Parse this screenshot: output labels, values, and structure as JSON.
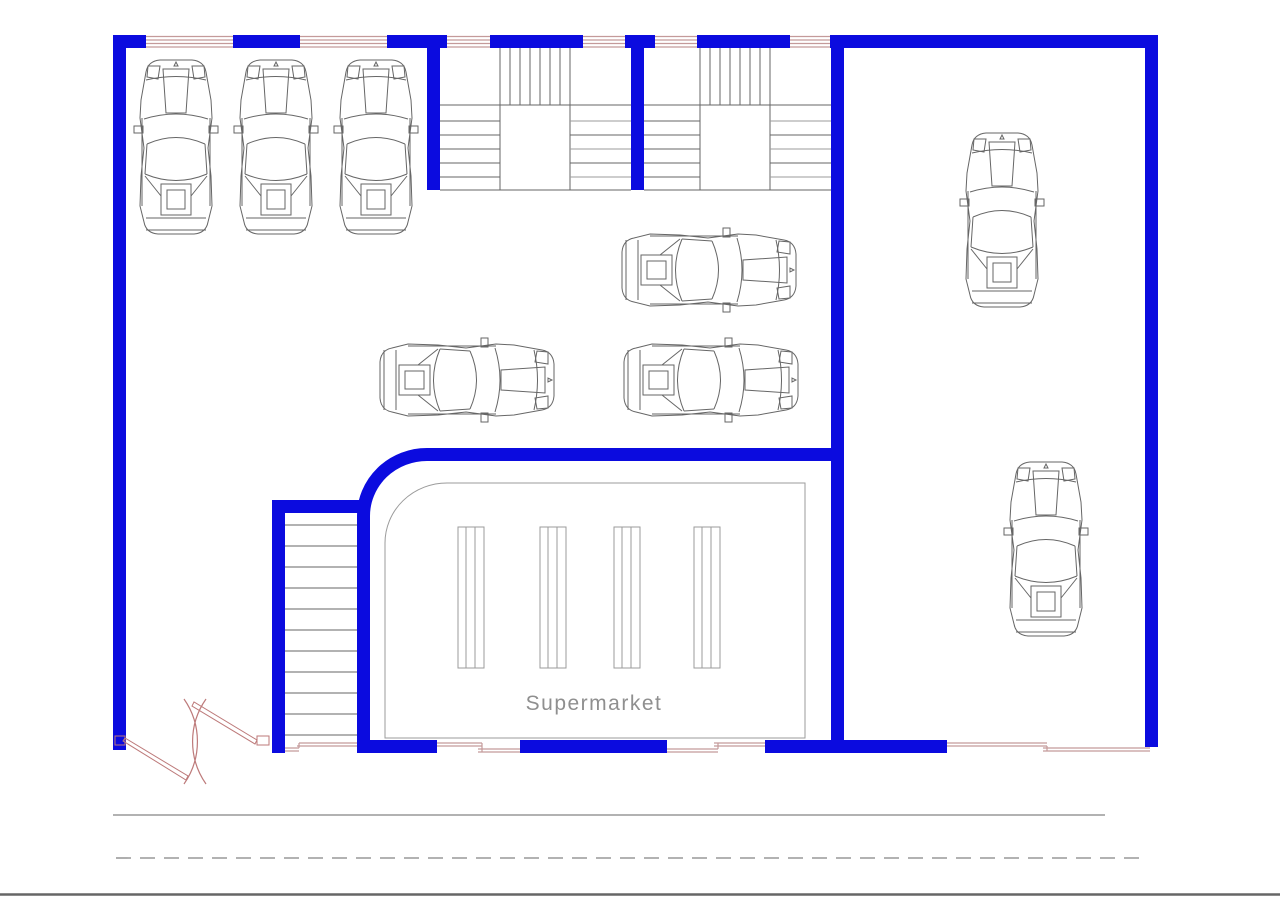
{
  "document": {
    "type": "cad-floor-plan",
    "description": "Ground floor plan: parking garage with cars, two upper stair cores, lower staircase and supermarket area, road lines below"
  },
  "labels": {
    "supermarket": "Supermarket"
  },
  "colors": {
    "bg": "#ffffff",
    "wall": "#0b0bdf",
    "window": "#c49a9a",
    "door": "#bd7a7a",
    "line": "#666666",
    "light": "#9b9b9b",
    "road": "#999999",
    "text": "#8f8f8f"
  },
  "inventory": {
    "cars_vertical": 5,
    "cars_horizontal": 3,
    "top_stairwells": 2,
    "bottom_staircases": 1,
    "shelf_units": 4,
    "top_wall_windows": 6,
    "bottom_wall_openings": 4,
    "double_door_leaves": 2,
    "road_lines": [
      "solid",
      "dashed",
      "solid"
    ]
  }
}
